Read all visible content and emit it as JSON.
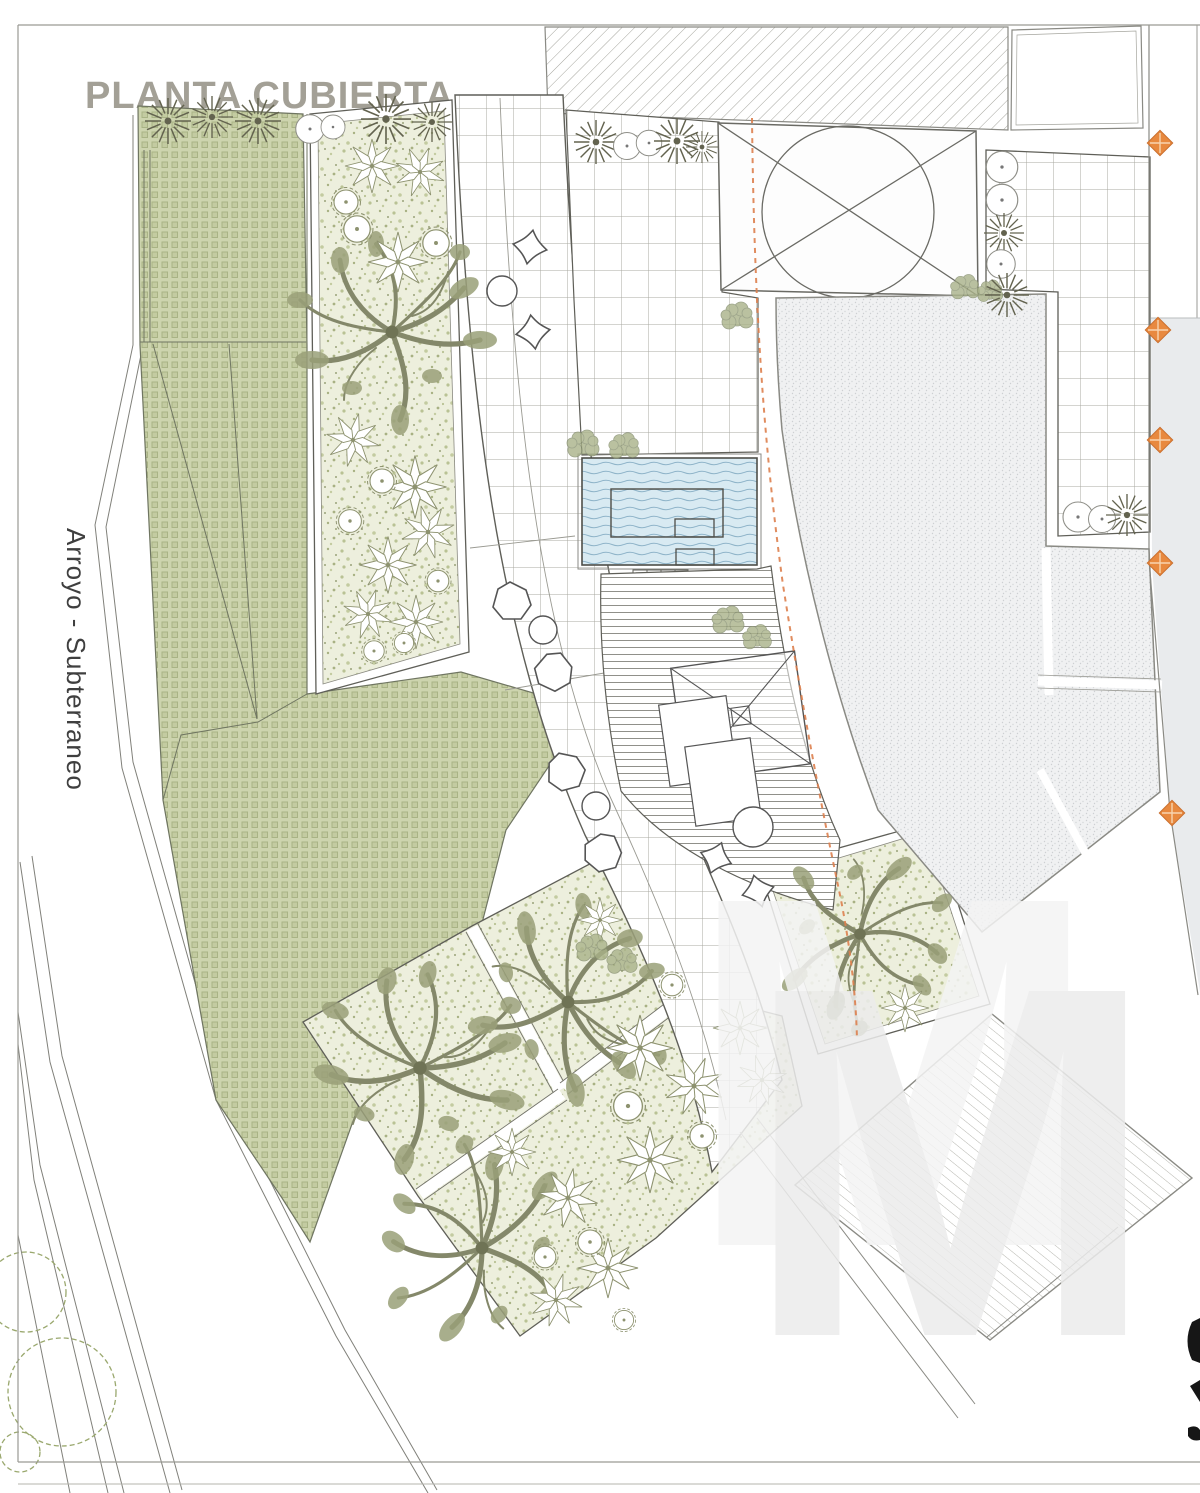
{
  "title": {
    "text": "PLANTA CUBIERTA"
  },
  "side_label": {
    "text": "Arroyo - Subterraneo"
  },
  "watermark": {
    "text": "M"
  },
  "colors": {
    "roof_garden_green": "#cdd4ae",
    "green_grid_line": "#a9b385",
    "planting_speckle_bg": "#edefdd",
    "water_blue": "#d8eaf2",
    "water_wave_line": "#8fb4c9",
    "building_stipple": "#f0f1f2",
    "neighbor_gray": "#e9ebed",
    "marker_orange": "#e8893f",
    "dashed_line_orange": "#dd7f4e",
    "drawing_line_gray": "#6a6a64",
    "title_gray": "#a3a096",
    "tree_olive": "#84886a"
  },
  "markers": {
    "boundary_diamonds": [
      {
        "x": 1160,
        "y": 143
      },
      {
        "x": 1158,
        "y": 330
      },
      {
        "x": 1160,
        "y": 440
      },
      {
        "x": 1160,
        "y": 563
      },
      {
        "x": 1172,
        "y": 813
      }
    ]
  }
}
